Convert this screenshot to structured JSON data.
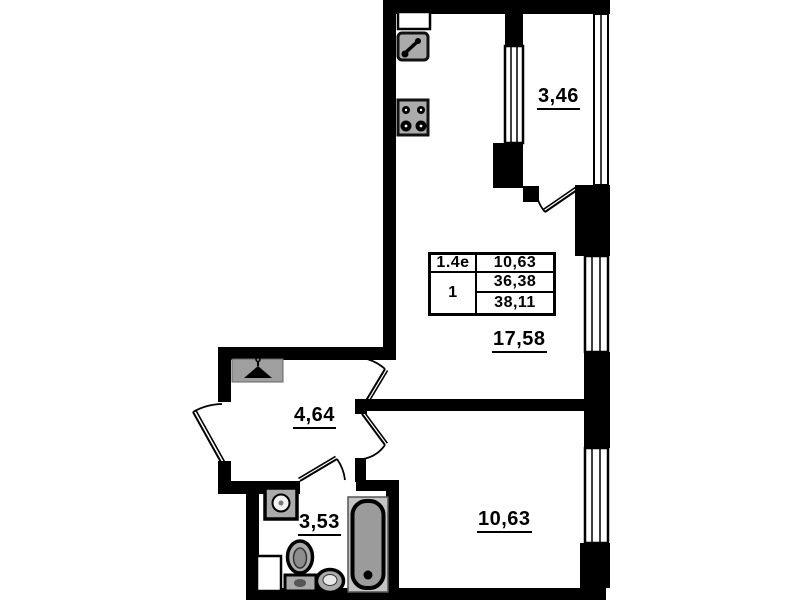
{
  "drawing": {
    "kind": "apartment floor plan",
    "rooms": {
      "balcony": {
        "area": "3,46"
      },
      "living_kitchen": {
        "area": "17,58"
      },
      "hallway": {
        "area": "4,64"
      },
      "bathroom": {
        "area": "3,53"
      },
      "bedroom": {
        "area": "10,63"
      }
    },
    "info_table": {
      "plan_type": "1.4e",
      "room_count": "1",
      "areas": [
        "10,63",
        "36,38",
        "38,11"
      ]
    },
    "icons": [
      "kitchen-cabinet-icon",
      "kitchen-sink-icon",
      "stove-icon",
      "wardrobe-hanger-icon",
      "washing-machine-icon",
      "toilet-icon",
      "washbasin-icon",
      "bathtub-icon",
      "duct-icon",
      "door-swing-icon",
      "window-icon"
    ],
    "colors": {
      "wall": "#000000",
      "background": "#ffffff",
      "fixture_fill": "#ababab",
      "bath_frame": "#c4c4c4"
    }
  }
}
